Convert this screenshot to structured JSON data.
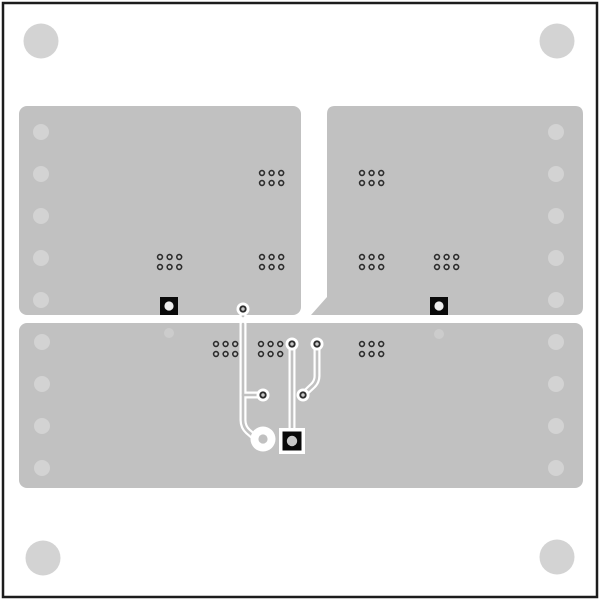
{
  "colors": {
    "background": "#ffffff",
    "board_outline": "#1c1c1c",
    "copper_pour": "#c1c1c1",
    "drill_hole": "#d3d3d3",
    "via_ring": "#2d2d2d",
    "via_center": "#c8c8c8",
    "pad_black": "#0a0a0a",
    "pad_hole_white": "#eeeeee",
    "trace_clearance": "#ffffff",
    "trace_core": "#c1c1c1",
    "faint_via": "#cccccc"
  },
  "board": {
    "x": 3,
    "y": 3,
    "width": 594,
    "height": 594,
    "outline_width": 2.5
  },
  "pours": [
    {
      "name": "copper-pour-top-left",
      "type": "rect",
      "x": 19,
      "y": 106,
      "width": 282,
      "height": 209,
      "rx": 8
    },
    {
      "name": "copper-pour-top-right",
      "type": "path",
      "d": "M335,106 L575,106 Q583,106 583,114 L583,307 Q583,315 575,315 L311,315 L327,297 L327,114 Q327,106 335,106 Z"
    },
    {
      "name": "copper-pour-bottom",
      "type": "rect",
      "x": 19,
      "y": 323,
      "width": 564,
      "height": 165,
      "rx": 8
    }
  ],
  "mounting_holes": {
    "r": 17.5,
    "items": [
      {
        "cx": 41,
        "cy": 41
      },
      {
        "cx": 557,
        "cy": 41
      },
      {
        "cx": 43,
        "cy": 558
      },
      {
        "cx": 557,
        "cy": 557
      }
    ]
  },
  "edge_holes": {
    "r": 8,
    "items": [
      {
        "cx": 41,
        "cy": 132
      },
      {
        "cx": 41,
        "cy": 174
      },
      {
        "cx": 41,
        "cy": 216
      },
      {
        "cx": 41,
        "cy": 258
      },
      {
        "cx": 41,
        "cy": 300
      },
      {
        "cx": 556,
        "cy": 132
      },
      {
        "cx": 556,
        "cy": 174
      },
      {
        "cx": 556,
        "cy": 216
      },
      {
        "cx": 556,
        "cy": 258
      },
      {
        "cx": 556,
        "cy": 300
      },
      {
        "cx": 42,
        "cy": 342
      },
      {
        "cx": 42,
        "cy": 384
      },
      {
        "cx": 42,
        "cy": 426
      },
      {
        "cx": 42,
        "cy": 468
      },
      {
        "cx": 556,
        "cy": 342
      },
      {
        "cx": 556,
        "cy": 384
      },
      {
        "cx": 556,
        "cy": 426
      },
      {
        "cx": 556,
        "cy": 468
      }
    ]
  },
  "via_clusters": {
    "cols": 3,
    "rows": 2,
    "dx": 9.6,
    "dy": 10,
    "via_r": 2.4,
    "ring_w": 1.6,
    "items": [
      {
        "x": 262,
        "y": 173
      },
      {
        "x": 160,
        "y": 257
      },
      {
        "x": 262,
        "y": 257
      },
      {
        "x": 362,
        "y": 173
      },
      {
        "x": 362,
        "y": 257
      },
      {
        "x": 437,
        "y": 257
      },
      {
        "x": 216,
        "y": 344
      },
      {
        "x": 261,
        "y": 344
      },
      {
        "x": 362,
        "y": 344
      }
    ]
  },
  "faint_vias": {
    "r": 5,
    "items": [
      {
        "cx": 169,
        "cy": 333
      },
      {
        "cx": 439,
        "cy": 334
      }
    ]
  },
  "traces": {
    "clearance_width": 7,
    "core_width": 2.6,
    "clearance_paths": [
      "M243,309 L243,420 Q243,427 248,431.5 L255,437.5",
      "M243,395 L263,395",
      "M292,344 L292,430",
      "M317,344 L317,376 Q317,381.5 313,385.5 L304,394"
    ],
    "core_paths": [
      "M243,309 L243,316",
      "M243,324 L243,420 Q243,427 248,431.5 L255,437.5",
      "M243,395 L263,395",
      "M292,344 L292,430",
      "M317,344 L317,376 Q317,381.5 313,385.5 L304,394"
    ]
  },
  "trace_vias": {
    "clearance_r": 6.5,
    "ring_r": 2.7,
    "ring_w": 1.9,
    "items": [
      {
        "cx": 243,
        "cy": 309
      },
      {
        "cx": 292,
        "cy": 344
      },
      {
        "cx": 317,
        "cy": 344
      },
      {
        "cx": 263,
        "cy": 395
      },
      {
        "cx": 303,
        "cy": 395
      }
    ]
  },
  "ring_pad": {
    "cx": 263,
    "cy": 439,
    "outer_r": 12.5,
    "hole_r": 4.6
  },
  "smd_pads": [
    {
      "name": "pad-top-left-pour",
      "x": 160,
      "y": 297,
      "size": 18,
      "hole_r": 4.6,
      "hole_fill": "#eeeeee"
    },
    {
      "name": "pad-top-right-pour",
      "x": 430,
      "y": 297,
      "size": 18,
      "hole_r": 4.6,
      "hole_fill": "#eeeeee"
    },
    {
      "name": "pad-bottom-center",
      "x": 282.5,
      "y": 431.5,
      "size": 19,
      "hole_r": 5.2,
      "hole_fill": "#c8c8c8",
      "frame": {
        "x": 279,
        "y": 428,
        "size": 26
      }
    }
  ]
}
